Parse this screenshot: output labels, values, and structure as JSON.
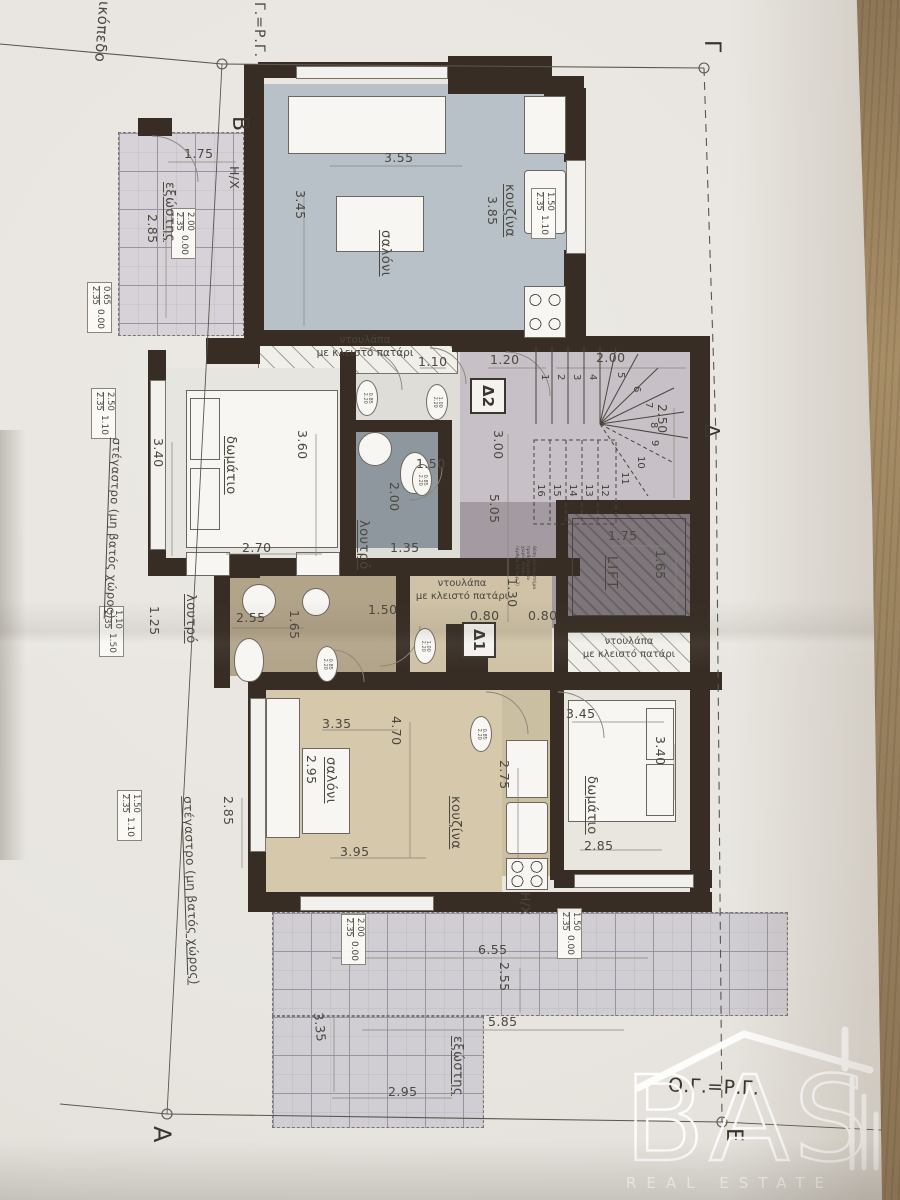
{
  "photo": {
    "wood_color": "#9a8160",
    "paper_color": "#e8e5e0"
  },
  "survey": {
    "plot_label": "οικόπεδο",
    "top_rule": "Γ.=Ρ.Γ.",
    "bottom_rule": "Ο.Γ.=Ρ.Γ.",
    "corners": {
      "b": "Β",
      "g": "Γ",
      "d": "Δ",
      "a": "Α",
      "e": "Ε"
    }
  },
  "units": {
    "d1": "Δ1",
    "d2": "Δ2"
  },
  "labels": {
    "living": "σαλόνι",
    "kitchen": "κουζίνα",
    "bedroom": "δωμάτιο",
    "bath": "λουτρό",
    "balcony": "εξώστης",
    "heater": "Η/Χ",
    "closet_line1": "ντουλάπα",
    "closet_line2": "με κλειστό πατάρι",
    "canopy": "στέγαστρο (μη βατός χώρος)",
    "lift": "LIFT",
    "lift_note": "θέση ανελκυστήρα\nπροδιαγραφών\nχωρίς σκάφη\n(άρθρο 26 παρ.3)"
  },
  "dims": [
    "3.55",
    "3.45",
    "1.75",
    "2.85",
    "3.85",
    "1.10",
    "1.20",
    "2.00",
    "2.50",
    "3.00",
    "5.05",
    "1.30",
    "0.80",
    "0.80",
    "1.75",
    "1.65",
    "3.40",
    "3.60",
    "2.70",
    "1.50",
    "2.00",
    "1.35",
    "1.25",
    "2.55",
    "1.65",
    "1.50",
    "3.35",
    "4.70",
    "3.95",
    "2.95",
    "2.75",
    "3.45",
    "3.40",
    "2.85",
    "6.55",
    "2.55",
    "5.85",
    "3.35",
    "2.95",
    "2.85"
  ],
  "markers": [
    {
      "over": "2.00",
      "under": "2.35",
      "level": "0.00"
    },
    {
      "over": "0.65",
      "under": "2.35",
      "level": "0.00"
    },
    {
      "over": "1.50",
      "under": "2.35",
      "level": "1.10"
    },
    {
      "over": "2.50",
      "under": "2.35",
      "level": "1.10"
    },
    {
      "over": "1.10",
      "under": "2.35",
      "level": "1.50"
    },
    {
      "over": "1.50",
      "under": "2.35",
      "level": "1.10"
    },
    {
      "over": "2.00",
      "under": "2.35",
      "level": "0.00"
    },
    {
      "over": "1.50",
      "under": "2.35",
      "level": "0.00"
    }
  ],
  "door_tags": [
    "0.85\n2.20",
    "1.00\n2.20",
    "0.85\n2.20",
    "1.00\n2.20",
    "0.85\n2.20",
    "0.85\n2.20"
  ],
  "stairs": {
    "numbers": [
      "1",
      "2",
      "3",
      "4",
      "5",
      "6",
      "7",
      "8",
      "9",
      "10",
      "11",
      "12",
      "13",
      "14",
      "15",
      "16"
    ]
  },
  "logo": {
    "name": "BAS",
    "tagline": "REAL ESTATE"
  }
}
